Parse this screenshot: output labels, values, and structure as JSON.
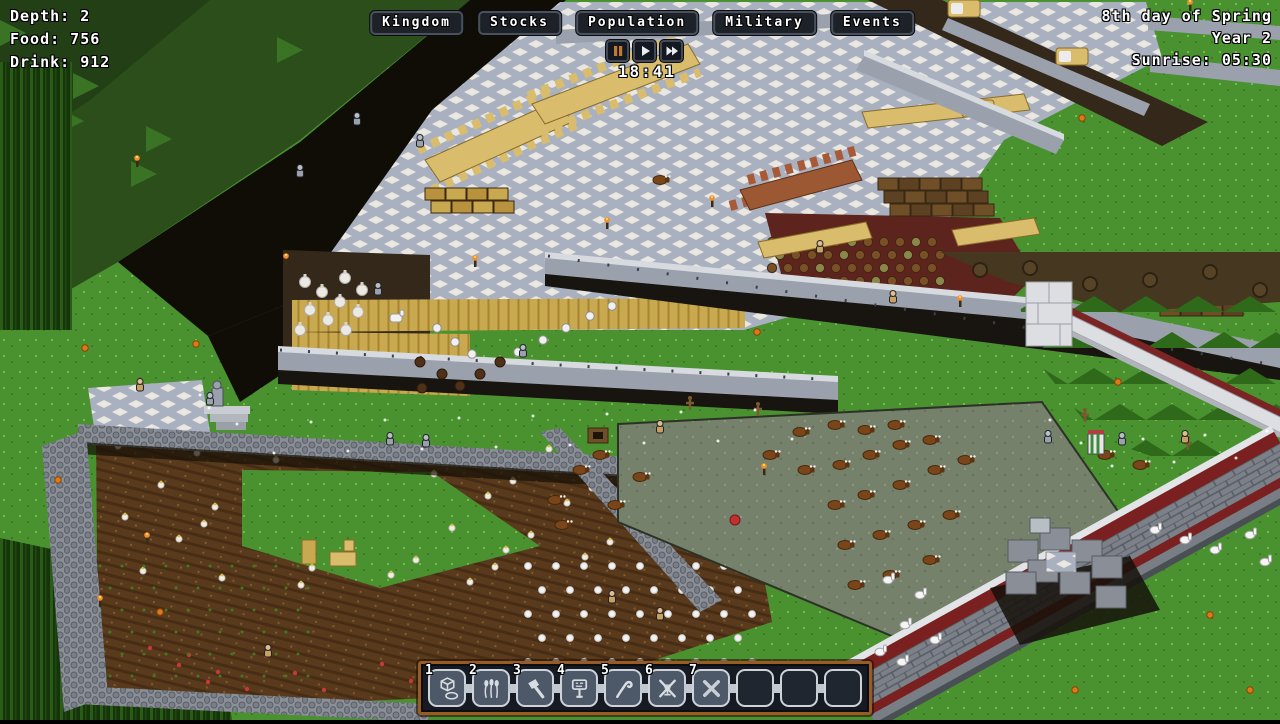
{
  "hud": {
    "stats": {
      "lines": [
        "Depth: 2",
        "Food: 756",
        "Drink: 912"
      ]
    },
    "menu": {
      "items": [
        "Kingdom",
        "Stocks",
        "Population",
        "Military",
        "Events"
      ]
    },
    "time": {
      "clock": "18:41",
      "buttons": [
        "pause",
        "play",
        "fast-forward"
      ]
    },
    "calendar": {
      "date": "8th day of Spring",
      "year": "Year 2",
      "sunrise": "Sunrise: 05:30"
    },
    "hotbar": {
      "slots": [
        {
          "number": "1",
          "icon": "terrain-cube-icon"
        },
        {
          "number": "2",
          "icon": "plants-icon"
        },
        {
          "number": "3",
          "icon": "build-hammer-icon"
        },
        {
          "number": "4",
          "icon": "stockpile-sign-icon"
        },
        {
          "number": "5",
          "icon": "crowbar-icon"
        },
        {
          "number": "6",
          "icon": "forbid-trap-icon"
        },
        {
          "number": "7",
          "icon": "cancel-x-icon"
        },
        {
          "number": "",
          "icon": ""
        },
        {
          "number": "",
          "icon": ""
        },
        {
          "number": "",
          "icon": ""
        }
      ]
    },
    "colors": {
      "hud_text": "#ffffff",
      "hotbar_border": "#9a5a24",
      "pause_active": "#c27a2e",
      "slot_border": "#ced3d9",
      "wall_accent": "#7a2020"
    }
  }
}
